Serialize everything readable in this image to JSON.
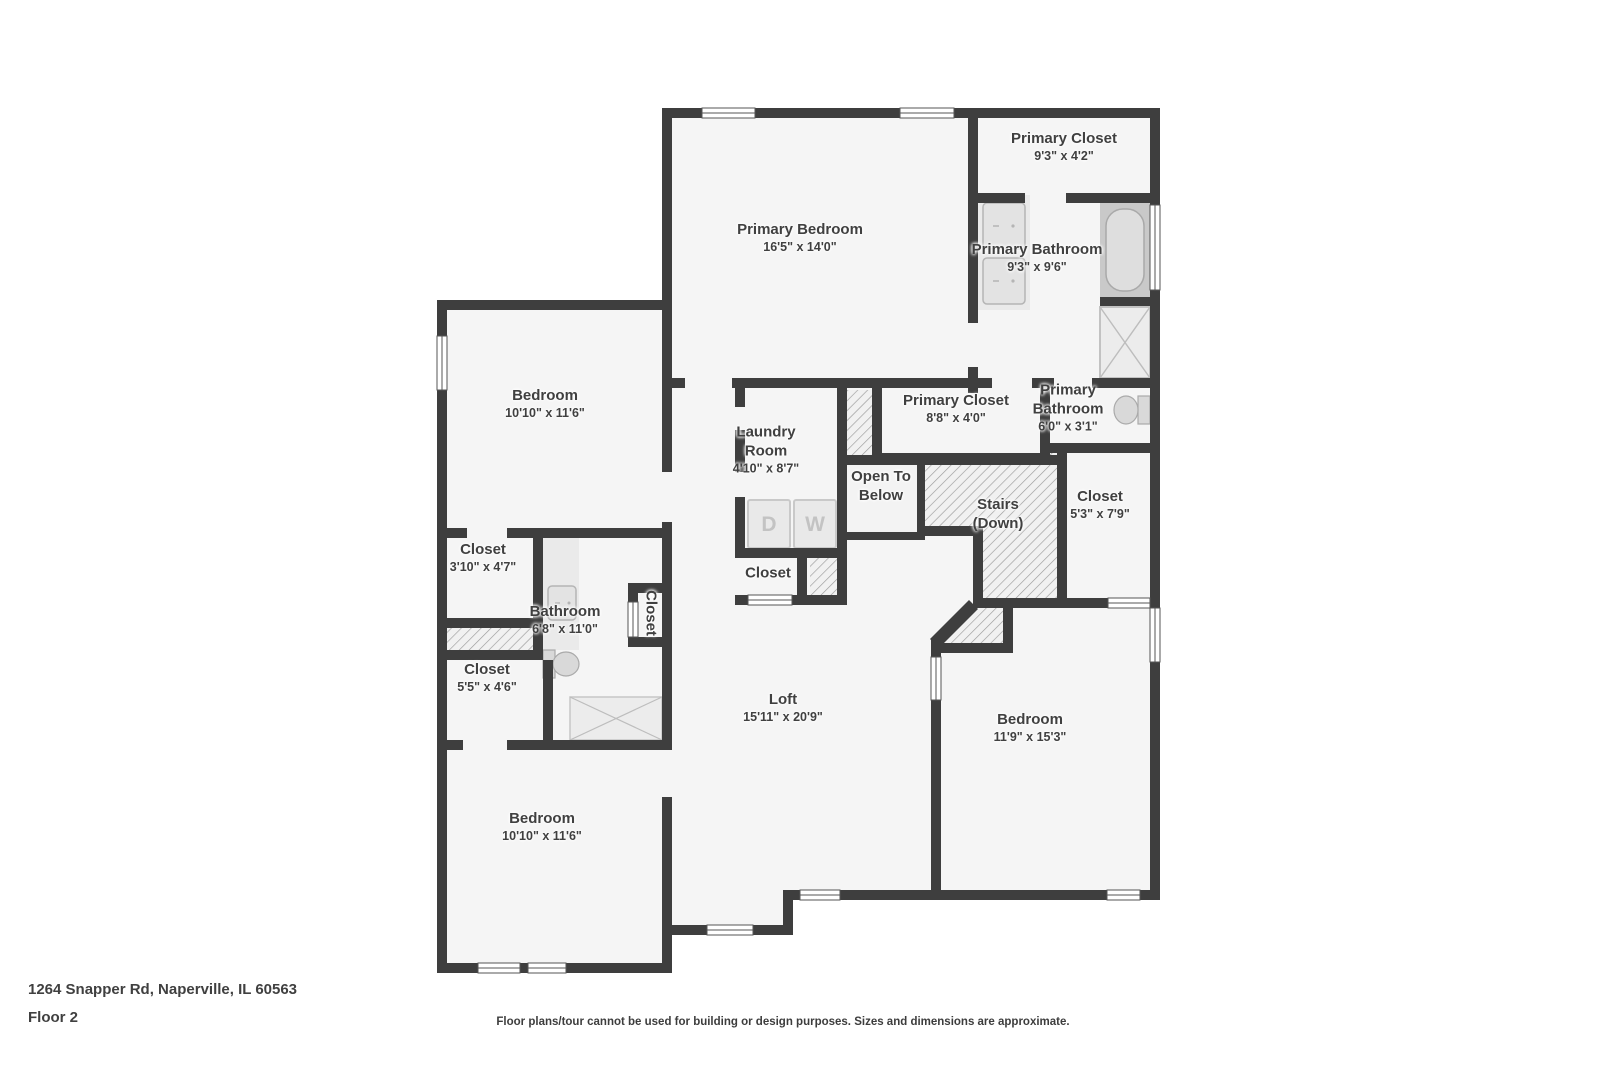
{
  "palette": {
    "wall": "#3e3e3e",
    "room_fill": "#f5f5f5",
    "hatch_line": "#9b9b9b",
    "fixture_fill": "#e3e3e3",
    "fixture_stroke": "#b5b5b5",
    "text": "#404040"
  },
  "floorplan": {
    "rooms": [
      {
        "id": "primary-bedroom",
        "name": "Primary Bedroom",
        "dims": "16'5\" x 14'0\""
      },
      {
        "id": "primary-closet",
        "name": "Primary Closet",
        "dims": "9'3\" x 4'2\""
      },
      {
        "id": "primary-bathroom",
        "name": "Primary Bathroom",
        "dims": "9'3\" x 9'6\""
      },
      {
        "id": "bedroom-upper-left",
        "name": "Bedroom",
        "dims": "10'10\" x 11'6\""
      },
      {
        "id": "laundry-room",
        "name": "Laundry Room",
        "dims": "4'10\" x 8'7\""
      },
      {
        "id": "primary-closet-2",
        "name": "Primary Closet",
        "dims": "8'8\" x 4'0\""
      },
      {
        "id": "primary-bathroom-2",
        "name": "Primary Bathroom",
        "dims": "6'0\" x 3'1\""
      },
      {
        "id": "open-to-below",
        "name": "Open To Below",
        "dims": ""
      },
      {
        "id": "stairs-down",
        "name": "Stairs (Down)",
        "dims": ""
      },
      {
        "id": "closet-right",
        "name": "Closet",
        "dims": "5'3\" x 7'9\""
      },
      {
        "id": "closet-left-small",
        "name": "Closet",
        "dims": "3'10\" x 4'7\""
      },
      {
        "id": "bathroom",
        "name": "Bathroom",
        "dims": "6'8\" x 11'0\""
      },
      {
        "id": "closet-vertical",
        "name": "Closet",
        "dims": ""
      },
      {
        "id": "closet-left-lower",
        "name": "Closet",
        "dims": "5'5\" x 4'6\""
      },
      {
        "id": "loft",
        "name": "Loft",
        "dims": "15'11\" x 20'9\""
      },
      {
        "id": "bedroom-right",
        "name": "Bedroom",
        "dims": "11'9\" x 15'3\""
      },
      {
        "id": "bedroom-bottom-left",
        "name": "Bedroom",
        "dims": "10'10\" x 11'6\""
      },
      {
        "id": "closet-laundry",
        "name": "Closet",
        "dims": ""
      }
    ],
    "appliances": {
      "dryer": "D",
      "washer": "W"
    }
  },
  "footer": {
    "address": "1264 Snapper Rd, Naperville, IL 60563",
    "floor": "Floor 2",
    "disclaimer": "Floor plans/tour cannot be used for building or design purposes. Sizes and dimensions are approximate."
  }
}
